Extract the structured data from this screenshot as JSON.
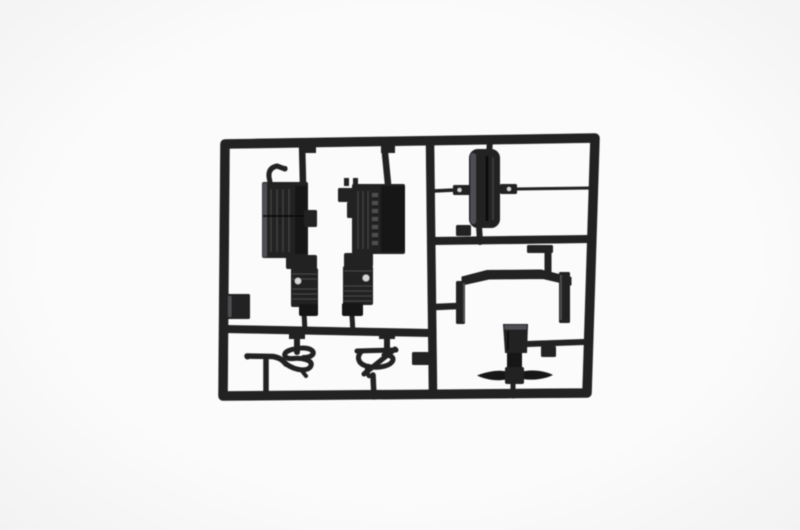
{
  "meta": {
    "description": "Product photograph of a dark charcoal-black injection-molded plastic model kit sprue (parts tree) centered on a plain white background. The rectangular sprue frame is divided by internal rails into four compartments holding truck-model parts.",
    "subject": "model kit sprue with molded parts",
    "background": "plain white studio backdrop",
    "visible_text": "none"
  },
  "colors": {
    "background": "#fbfbfb",
    "plastic_dark": "#202023",
    "plastic_deep": "#141416",
    "plastic_highlight": "#4d4d52",
    "plastic_rib": "#3c3c41",
    "hole_light": "#d6d6d6"
  },
  "sprue": {
    "material": "black styrene plastic",
    "frame_shape": "rounded rectangle with one vertical and two horizontal divider rails",
    "compartments": 4,
    "part_count_main": 7,
    "part_count_small": 3,
    "parts": [
      {
        "name": "ribbed-box-with-shock-cylinder-left",
        "location": "upper-left compartment, left",
        "details": "rectangular ribbed block with curved hook lever on top and ribbed cylinder with bright hole below"
      },
      {
        "name": "ribbed-box-with-shock-cylinder-right",
        "location": "upper-left compartment, right",
        "details": "rectangular ribbed block with side steps, two top posts, ribbed cylinder with bright hole below"
      },
      {
        "name": "cylindrical-tank",
        "location": "upper-right compartment",
        "details": "vertical rounded tank with two pierced mounting tabs connected to frame on both sides"
      },
      {
        "name": "arched-bracket-frame",
        "location": "middle-right compartment",
        "details": "arched crossbar with two vertical legs"
      },
      {
        "name": "coiled-hose-left",
        "location": "lower-left compartment, left",
        "details": "horizontal arm ending in tight S-shaped coil"
      },
      {
        "name": "coiled-hose-right",
        "location": "lower-left compartment, right",
        "details": "tight coil with diagonal strand"
      },
      {
        "name": "pedestal-with-winged-base",
        "location": "lower-right compartment",
        "details": "tapered block on pedestal over bowtie-shaped base plate"
      },
      {
        "name": "square-tab",
        "location": "inside left rail above divider",
        "details": "small square molding tab"
      },
      {
        "name": "small-block-center",
        "location": "left of vertical rail below left divider",
        "details": "small rectangular block"
      },
      {
        "name": "small-block-under-tank",
        "location": "on right divider below tank",
        "details": "small rectangular block"
      }
    ]
  }
}
